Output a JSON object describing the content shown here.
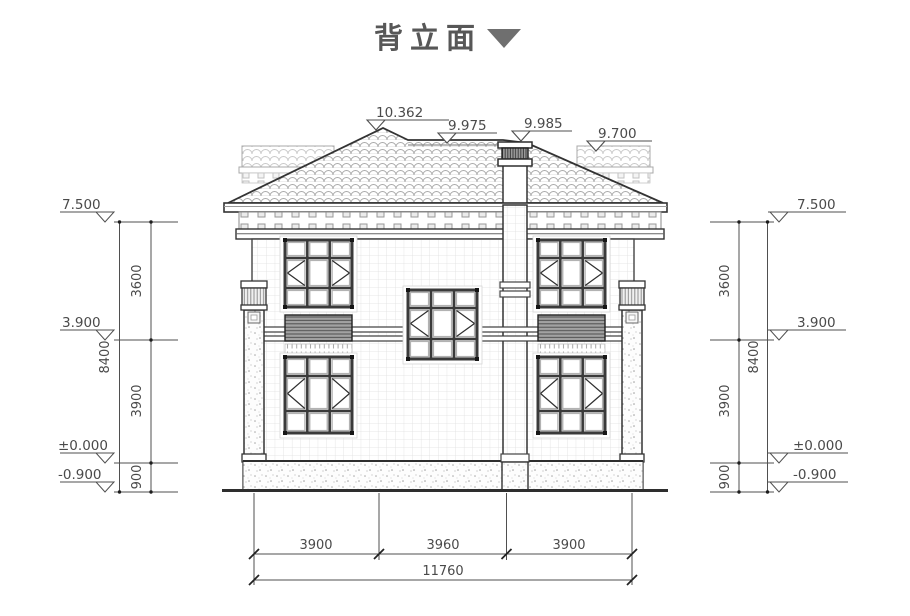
{
  "title": {
    "text": "背立面",
    "marker": "down-triangle-icon"
  },
  "levels": {
    "roof": [
      "10.362",
      "9.975",
      "9.985",
      "9.700"
    ],
    "left": [
      "7.500",
      "3.900",
      "±0.000",
      "-0.900"
    ],
    "right": [
      "7.500",
      "3.900",
      "±0.000",
      "-0.900"
    ]
  },
  "dims": {
    "left": {
      "segments": [
        "3600",
        "3900",
        "900"
      ],
      "total": "8400"
    },
    "right": {
      "segments": [
        "3600",
        "3900",
        "900"
      ],
      "total": "8400"
    },
    "bottom": {
      "segments": [
        "3900",
        "3960",
        "3900"
      ],
      "total": "11760"
    }
  }
}
